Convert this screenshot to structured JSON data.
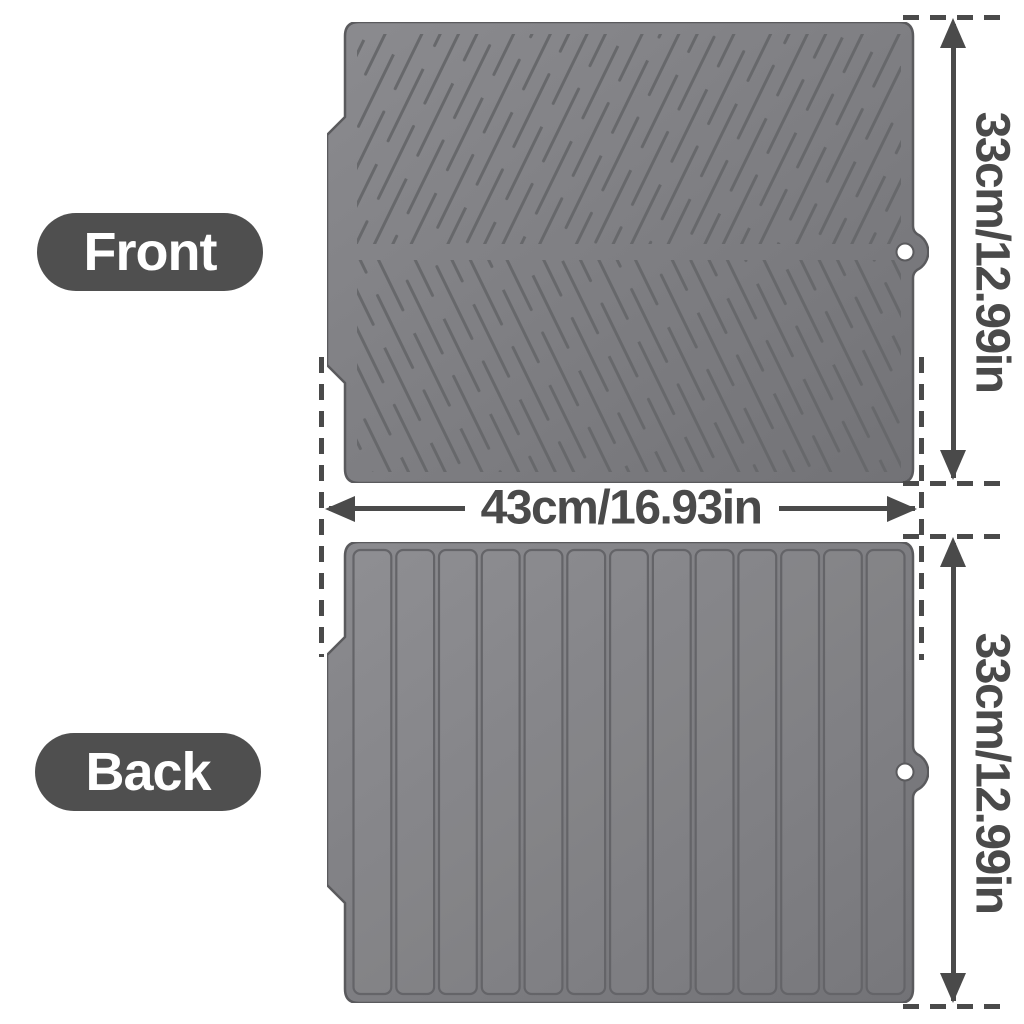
{
  "labels": {
    "front": "Front",
    "back": "Back"
  },
  "dims": {
    "height_front": "33cm/12.99in",
    "height_back": "33cm/12.99in",
    "width": "43cm/16.93in"
  },
  "mats": {
    "front": {
      "texture": "diagonal-herringbone-grooves",
      "hang_hole": true
    },
    "back": {
      "texture": "vertical-panels",
      "panel_count": 13,
      "hang_hole": true
    }
  },
  "colors": {
    "annotation": "#4a4a4a",
    "label_pill_bg": "#4f4f4f",
    "label_text": "#ffffff",
    "mat_light": "#8b8b8f",
    "mat_dark": "#727276",
    "groove": "#67686b",
    "outline": "#5a5a5d",
    "panel_stroke": "#646468",
    "hole_fill": "#ffffff",
    "page_bg": "#ffffff"
  }
}
